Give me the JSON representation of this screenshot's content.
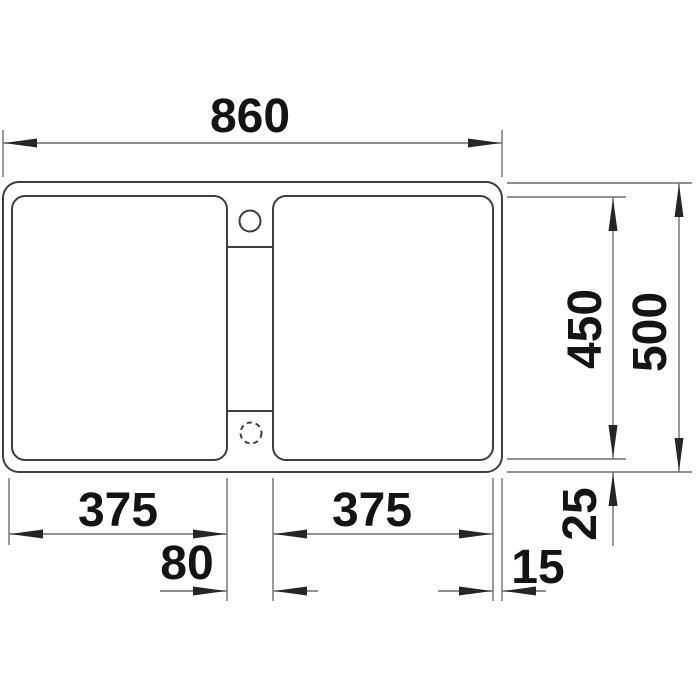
{
  "drawing": {
    "subject": "double-bowl inset sink, plan view technical drawing",
    "units": "mm",
    "labels": {
      "overall_width": "860",
      "overall_depth": "500",
      "bowl_depth": "450",
      "left_bowl_width": "375",
      "right_bowl_width": "375",
      "divider_width": "80",
      "right_rim_offset": "15",
      "bottom_rim_offset": "25"
    },
    "features": {
      "tap_hole": "tap hole (solid circle)",
      "knockout_hole": "pre-punched hole (dashed circle)"
    },
    "colors": {
      "object_line": "#3e3e3e",
      "dimension_line": "#6e6e6e",
      "arrow": "#262626",
      "text": "#141414",
      "background": "#ffffff"
    }
  }
}
